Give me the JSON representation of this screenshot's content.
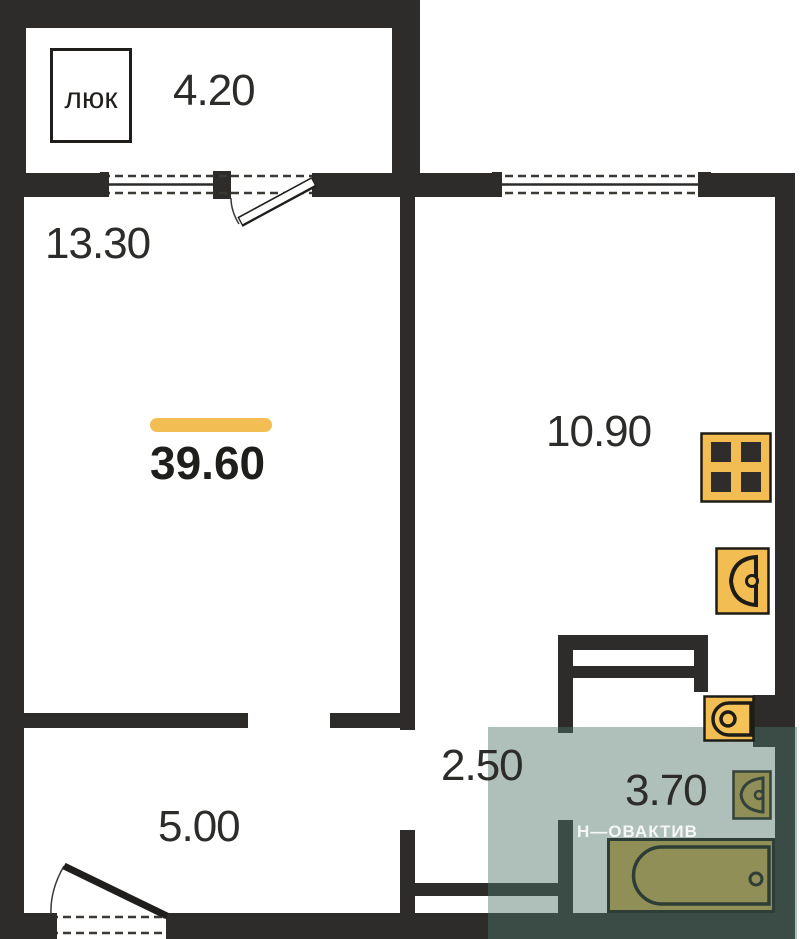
{
  "plan": {
    "hatch_label": "люк",
    "watermark": "Н—ОВАКТИВ",
    "total_area": "39.60",
    "rooms": {
      "balcony": "4.20",
      "living": "13.30",
      "kitchen": "10.90",
      "corridor": "2.50",
      "bathroom": "3.70",
      "hallway": "5.00"
    },
    "colors": {
      "wall": "#2d2c2a",
      "fixture_yellow": "#F2BE53",
      "fixture_olive": "#C9A84D",
      "bathroom_overlay": "rgba(77,112,103,0.45)",
      "accent_bar": "#F2BE53"
    }
  }
}
